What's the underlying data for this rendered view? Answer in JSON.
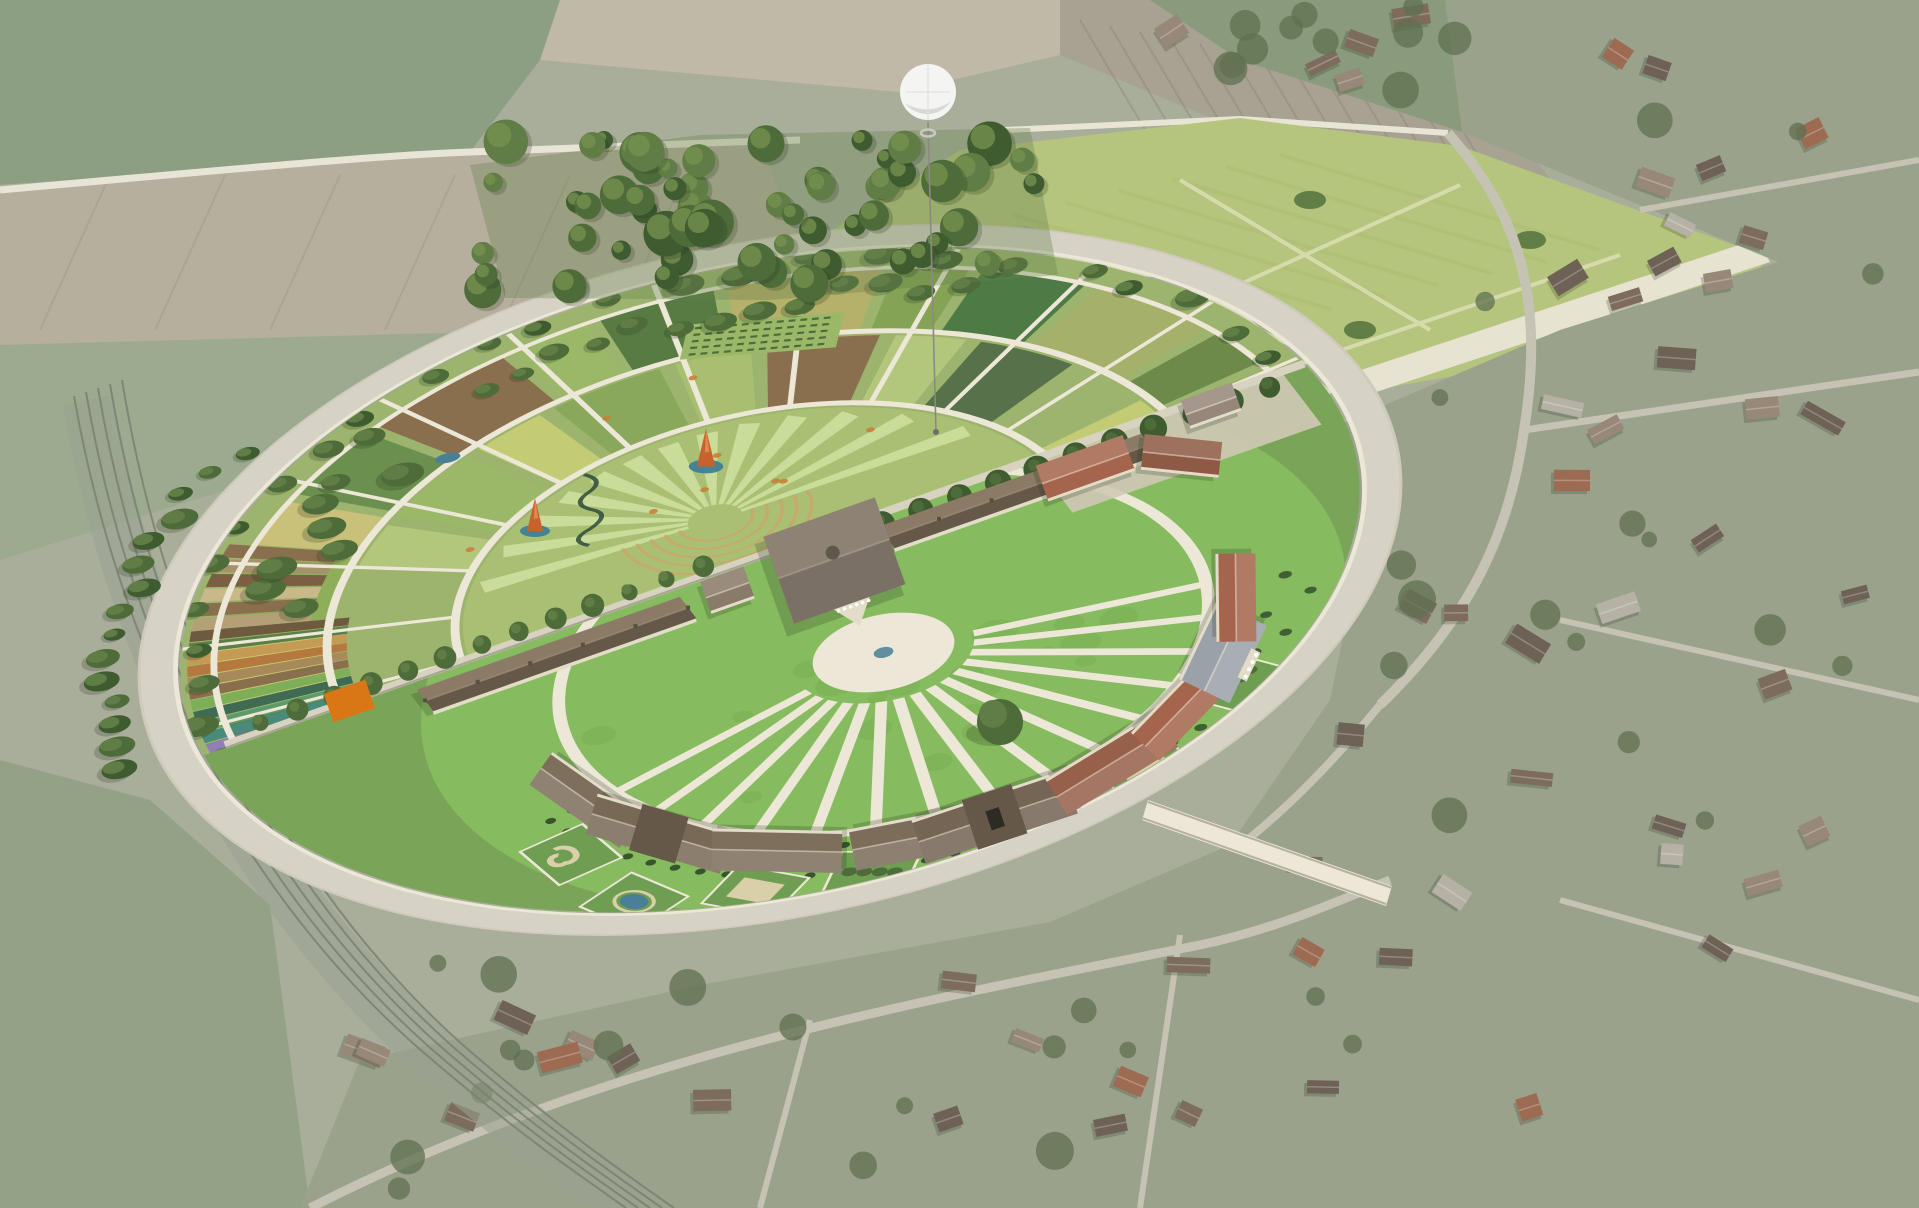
{
  "scene": {
    "description": "Aerial photomontage of the Royal Saltworks of Arc-et-Senans: historic semicircular salt-works completed into a full circle by fan-shaped gardens, white tethered balloon above a wooded grove, bright meadow to the north-east, muted farmland, railway curve at left and village at right and bottom.",
    "landmarks": {
      "circle": "grand-circle-garden-complex",
      "garden_half": "fan-garden-semicircle",
      "saltworks_half": "historic-saltworks-semicircle",
      "balloon": "white-tethered-balloon",
      "forest": "north-grove",
      "meadow": "great-meadow",
      "railway": "railway-curve",
      "village": "arc-et-senans-village"
    },
    "counts": {
      "lawn_spokes": 15,
      "fan_rays": 13,
      "garden_wedges": 16,
      "arc_buildings": 9,
      "perimeter_trees": 26
    }
  },
  "palette": {
    "bg_base": "#a9ae9b",
    "field_green_1": "#8d9f82",
    "field_green_2": "#97a98b",
    "field_tan_1": "#c1b9a7",
    "field_tan_2": "#cdc5b3",
    "field_plow": "#b7af9d",
    "plow_line": "#a39b89",
    "road_muted": "#d6d3c6",
    "road_white": "#e9e5d6",
    "meadow": "#b5c57d",
    "meadow_stripe": "#aaba6e",
    "meadow_path": "#d8ddb0",
    "vineyard": "#a8a293",
    "vineyard_row": "#948c7b",
    "village_ground": "#9aa28c",
    "village_green": "#8a9a7c",
    "village_road": "#c6c3b4",
    "village_tree": "#5f7050",
    "roof_dark": "#6e6156",
    "roof_mid": "#7d6c5c",
    "roof_light": "#978878",
    "roof_red": "#9c6b52",
    "roof_pale": "#b5b1a5",
    "rail_band": "#9aa291",
    "rail_line": "#798070",
    "garden_lawn": "#9db46e",
    "fan_lawn": "#a9bf73",
    "fan_ray": "#d0e0a0",
    "path_cream": "#ece7d6",
    "path_edge": "#cfcaba",
    "tree_dark": "#3f5c31",
    "tree_mid": "#4e6b3a",
    "tree_light": "#5f7d45",
    "tree_hi": "#74914f",
    "salt_lawn": "#87bb5f",
    "salt_band": "#7aa458",
    "shrub": "#39552f",
    "roof_berne": "#8a7a66",
    "roof_berne_dark": "#655849",
    "roof_berne_hi": "#93836e",
    "roof_new_red": "#a5654c",
    "roof_new_red2": "#8f5a45",
    "roof_neo": "#9ba1a8",
    "bldg_wall": "#e3dcc9",
    "court": "#cfc9b6",
    "sand": "#d9cfa8",
    "wall_band": "#d8d2c0",
    "cone_orange": "#c8622d",
    "cone_base": "#3f7f96",
    "marker_orange": "#d97716",
    "accent_orange": "#c87f3a",
    "pond_blue": "#4a7f96",
    "balloon": "#f4f4f2",
    "balloon_shade": "#d8d8d4",
    "tether": "#8a8a82",
    "shadow": "rgba(35,48,28,0.22)",
    "plot_colors": [
      "#5d7f46",
      "#c3c96b",
      "#8fae5a",
      "#c9c07a",
      "#6b8f4e",
      "#8a6f4e",
      "#9ab868",
      "#577b43",
      "#b5b06a",
      "#85a355",
      "#4e7a46",
      "#a5b06b",
      "#6d8a4a",
      "#97b062",
      "#8fae5a",
      "#c3c96b"
    ],
    "mid_colors": [
      "#b3c77c",
      "#9ab868",
      "#c3cc74",
      "#89a85c",
      "#a8bf72",
      "#8a6f4e",
      "#b3c77c",
      "#57714a",
      "#9db46e",
      "#c3cc74"
    ],
    "strip_colors_a": [
      "#6b5a9e",
      "#8f7fb5",
      "#4a8a7a",
      "#5d9a6a",
      "#3f6b55",
      "#7fae58",
      "#8a6f4e",
      "#a88a5a",
      "#b5793f",
      "#c49a55",
      "#5d7f46",
      "#6e5a3f"
    ],
    "strip_colors_b": [
      "#b3a077",
      "#8a6f4e",
      "#c9b98a",
      "#7a5f42",
      "#a5916b",
      "#8a6f4e"
    ],
    "arc_roofs": [
      "#7e6e5c",
      "#786957",
      "#7e6e5c",
      "#7c6c5a",
      "#746554",
      "#96604a",
      "#a5654c",
      "#9ba1a8",
      "#a5654c"
    ]
  }
}
